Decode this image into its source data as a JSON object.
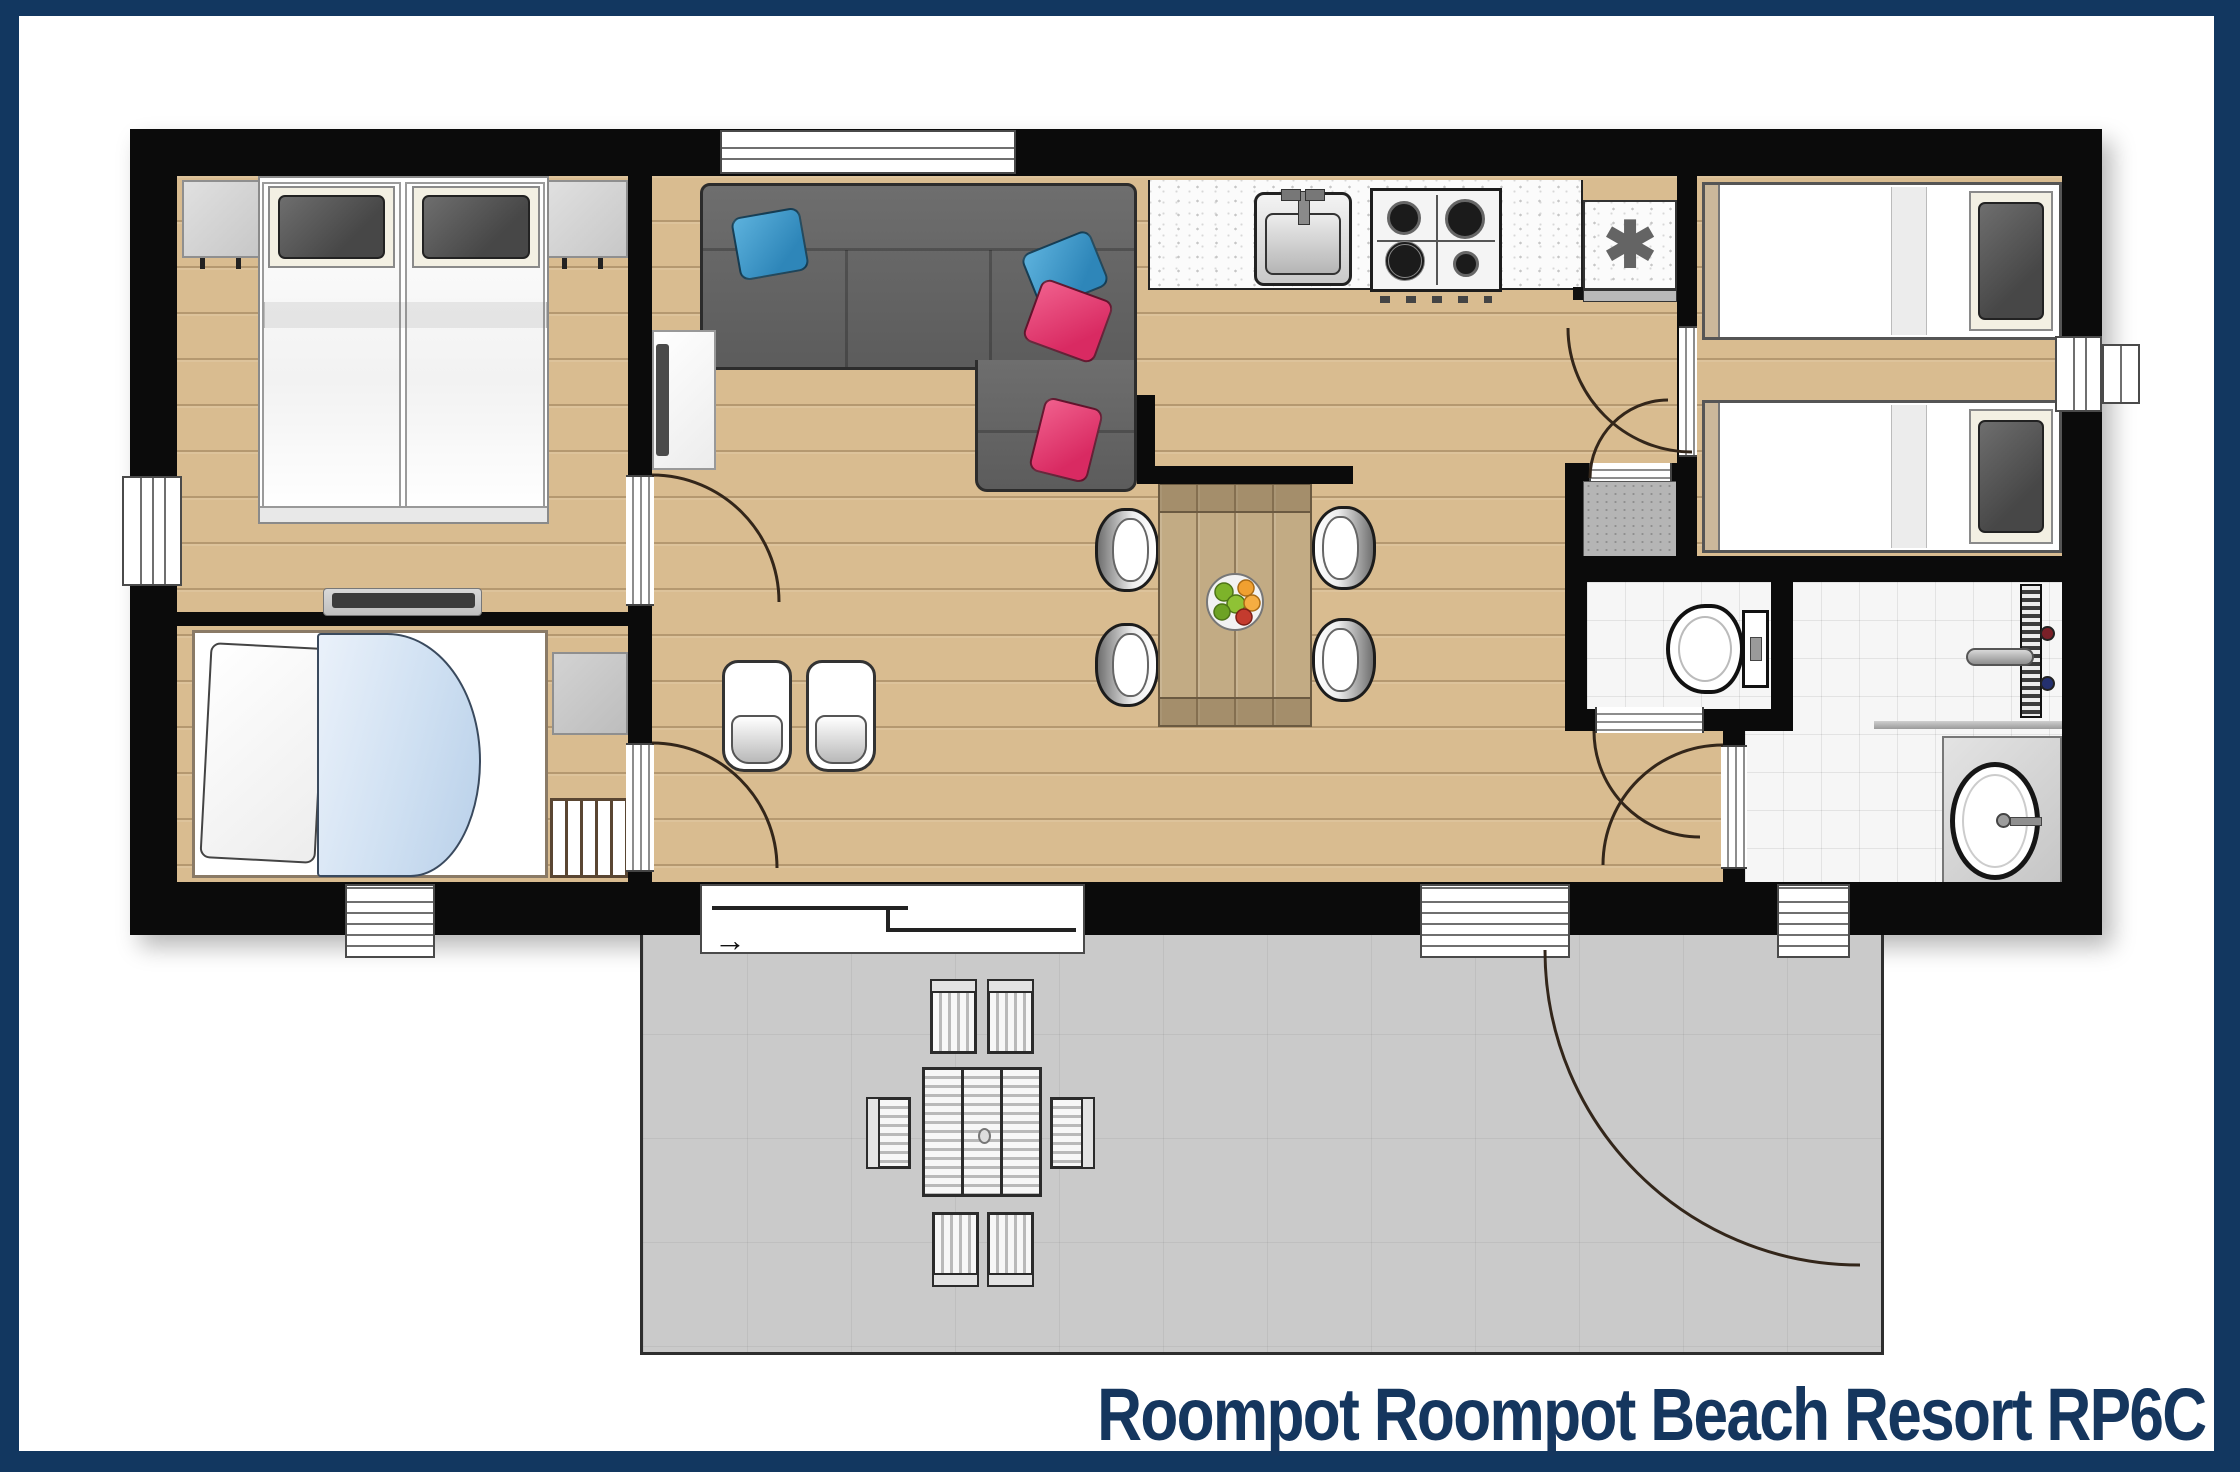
{
  "title": {
    "text": "Roompot Roompot Beach Resort RP6C",
    "color": "#15365e"
  },
  "icons": {
    "appliance_symbol": "✱",
    "door_direction_arrow": "→"
  },
  "palette": {
    "frame_navy": "#123760",
    "wall_black": "#0b0b0b",
    "wood_floor": "#d9bc90",
    "tile_white": "#f6f6f6",
    "terrace_gray": "#cacaca",
    "sofa_gray": "#636363",
    "pillow_blue": "#2e86b9",
    "pillow_pink": "#d92a62",
    "dining_table_wood": "#c2ab84",
    "blanket_light_blue": "#cfe0f2"
  }
}
